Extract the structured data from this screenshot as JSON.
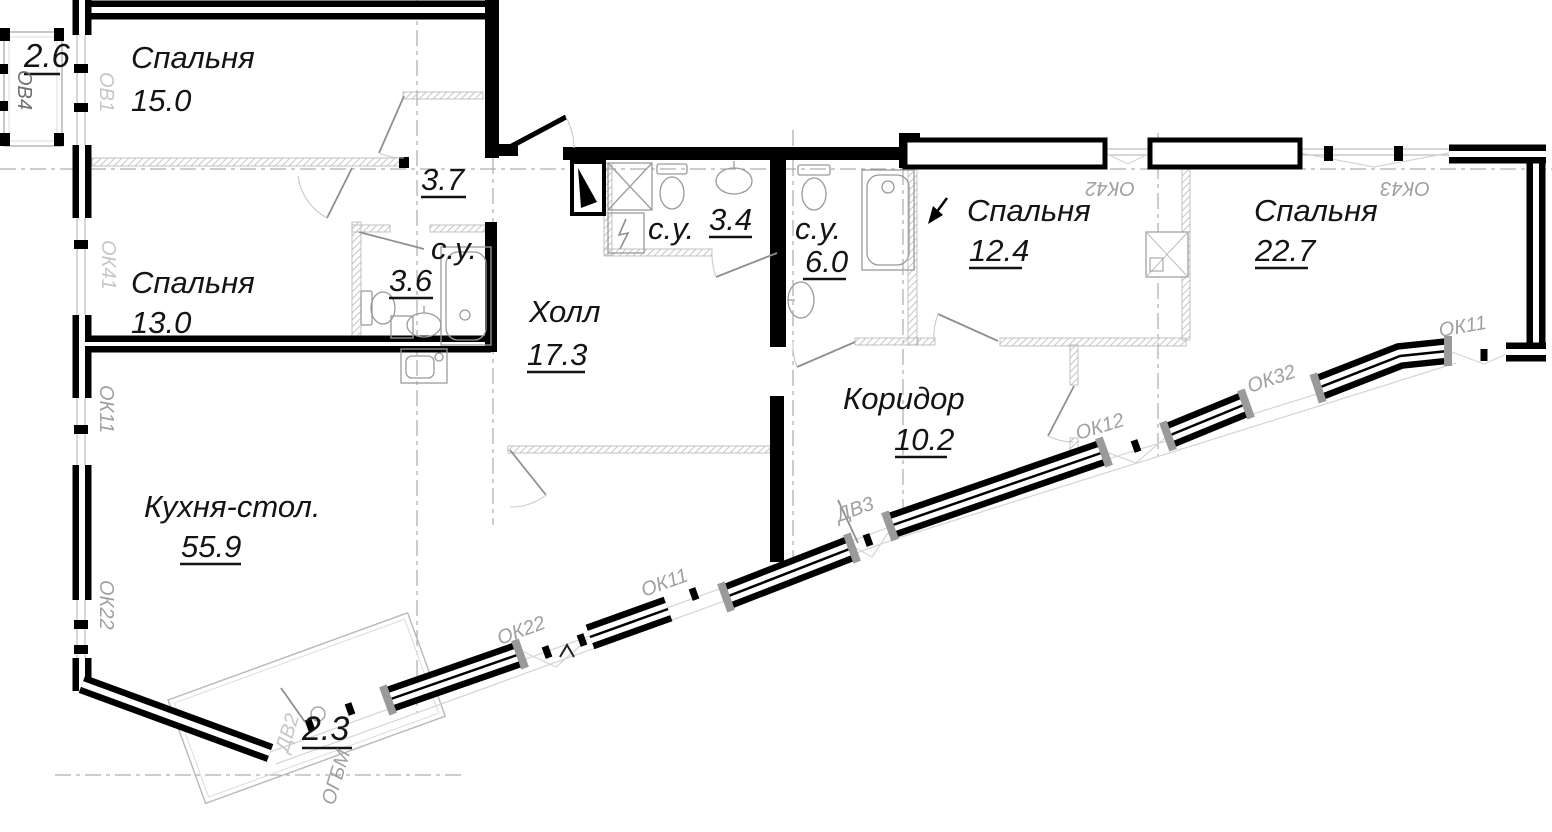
{
  "plan": {
    "title": "apartment floor plan",
    "rooms": {
      "bed15": {
        "name": "Спальня",
        "area": "15.0"
      },
      "bed13": {
        "name": "Спальня",
        "area": "13.0"
      },
      "bed124": {
        "name": "Спальня",
        "area": "12.4"
      },
      "bed227": {
        "name": "Спальня",
        "area": "22.7"
      },
      "kitchen": {
        "name": "Кухня-стол.",
        "area": "55.9"
      },
      "hall": {
        "name": "Холл",
        "area": "17.3"
      },
      "corridor": {
        "name": "Коридор",
        "area": "10.2"
      },
      "bath36": {
        "name": "с.у.",
        "area": "3.6"
      },
      "bath34": {
        "name": "с.у.",
        "area": "3.4"
      },
      "bath60": {
        "name": "с.у.",
        "area": "6.0"
      },
      "entry": {
        "area": "3.7"
      },
      "balcony_top": {
        "area": "2.6"
      },
      "balcony_bot": {
        "area": "2.3"
      }
    },
    "openings": {
      "ov4": "ОВ4",
      "ov1": "ОВ1",
      "ok41": "ОК41",
      "ok11_left": "ОК11",
      "ok22_left": "ОК22",
      "ok42": "ОК42",
      "ok43": "ОК43",
      "ok11_right": "ОК11",
      "ok32": "ОК32",
      "ok12": "ОК12",
      "ok11_bottom": "ОК11",
      "ok22_bottom": "ОК22",
      "dv3": "ДВ3",
      "dv2": "ДВ2",
      "ogbm": "ОГБМ"
    },
    "colors": {
      "wall": "#000000",
      "label": "#141414",
      "designation": "#a0a0a0",
      "designation_light": "#c6c6c6",
      "designation_dark": "#6e6e6e"
    }
  }
}
